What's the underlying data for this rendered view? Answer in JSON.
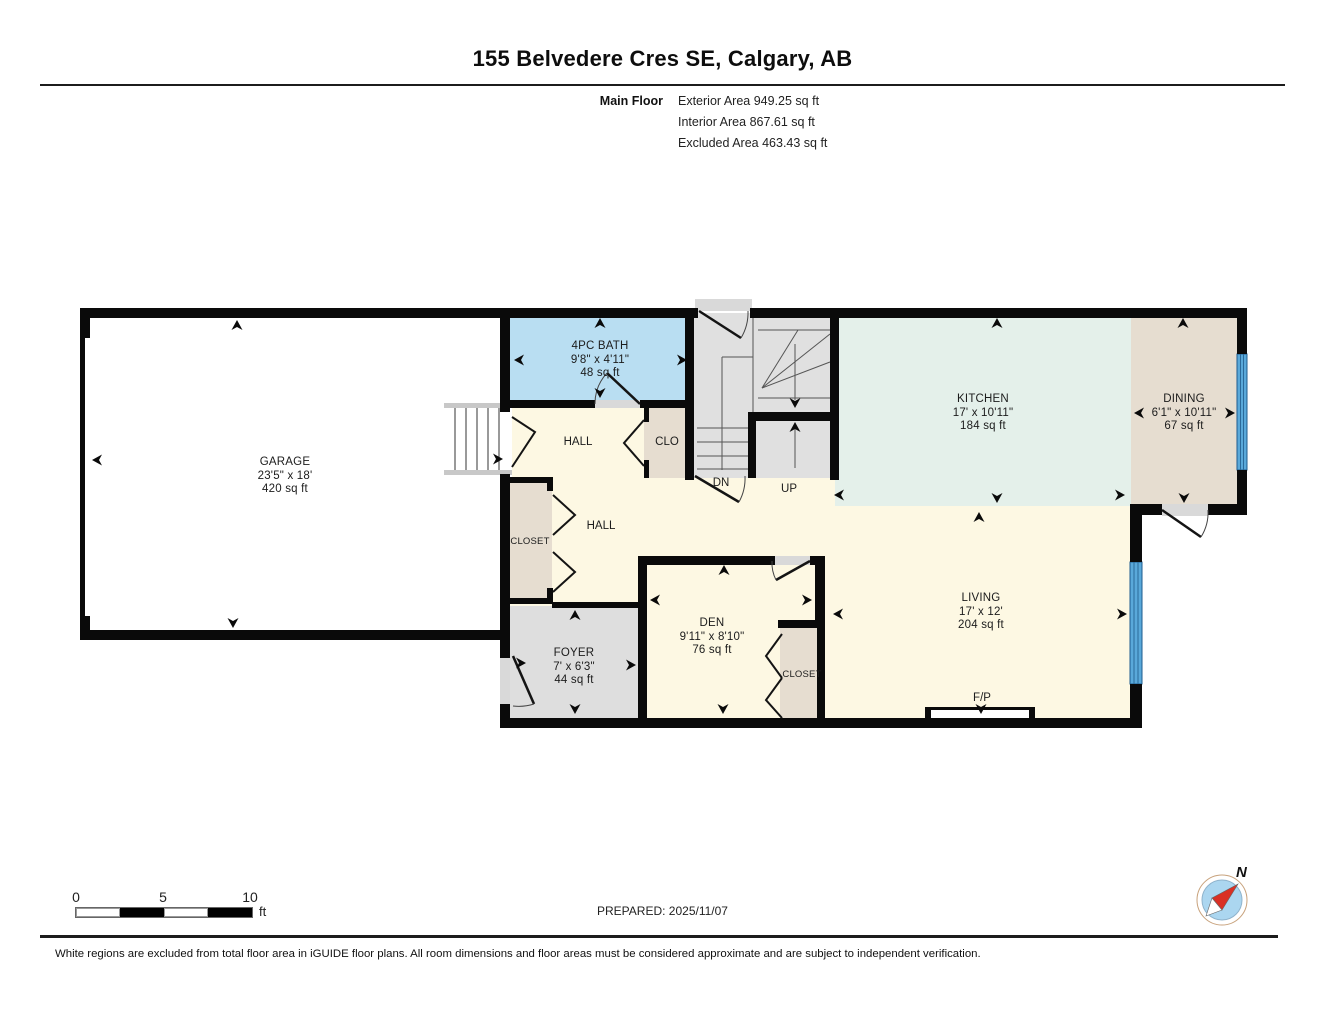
{
  "header": {
    "title": "155 Belvedere Cres SE, Calgary, AB",
    "floor_label": "Main Floor",
    "stats": [
      "Exterior Area 949.25 sq ft",
      "Interior Area 867.61 sq ft",
      "Excluded Area 463.43 sq ft"
    ]
  },
  "rooms": [
    {
      "name": "GARAGE",
      "dims": "23'5\" x 18'",
      "area": "420 sq ft"
    },
    {
      "name": "4PC BATH",
      "dims": "9'8\" x 4'11\"",
      "area": "48 sq ft"
    },
    {
      "name": "KITCHEN",
      "dims": "17' x 10'11\"",
      "area": "184 sq ft"
    },
    {
      "name": "DINING",
      "dims": "6'1\" x 10'11\"",
      "area": "67 sq ft"
    },
    {
      "name": "LIVING",
      "dims": "17' x 12'",
      "area": "204 sq ft"
    },
    {
      "name": "DEN",
      "dims": "9'11\" x 8'10\"",
      "area": "76 sq ft"
    },
    {
      "name": "FOYER",
      "dims": "7' x 6'3\"",
      "area": "44 sq ft"
    }
  ],
  "labels": {
    "hall_top": "HALL",
    "hall_main": "HALL",
    "clo": "CLO",
    "closet_left": "CLOSET",
    "closet_den": "CLOSET",
    "dn": "DN",
    "up": "UP",
    "fireplace": "F/P",
    "compass_north": "N"
  },
  "scale_bar": {
    "ticks": [
      "0",
      "5",
      "10"
    ],
    "unit": "ft"
  },
  "footer": {
    "prepared": "PREPARED: 2025/11/07",
    "disclaimer": "White regions are excluded from total floor area in iGUIDE floor plans. All room dimensions and floor areas must be considered approximate and are subject to independent verification."
  },
  "colors": {
    "wall": "#0a0a0a",
    "bath": "#b9def2",
    "kitchen": "#e4f0ea",
    "dining": "#e6ddd0",
    "floor_cream": "#fdf8e3",
    "excluded_gray": "#e0e0e0",
    "window_blue": "#5aa9da",
    "compass_red": "#d93025",
    "compass_blue": "#abd6f0"
  }
}
